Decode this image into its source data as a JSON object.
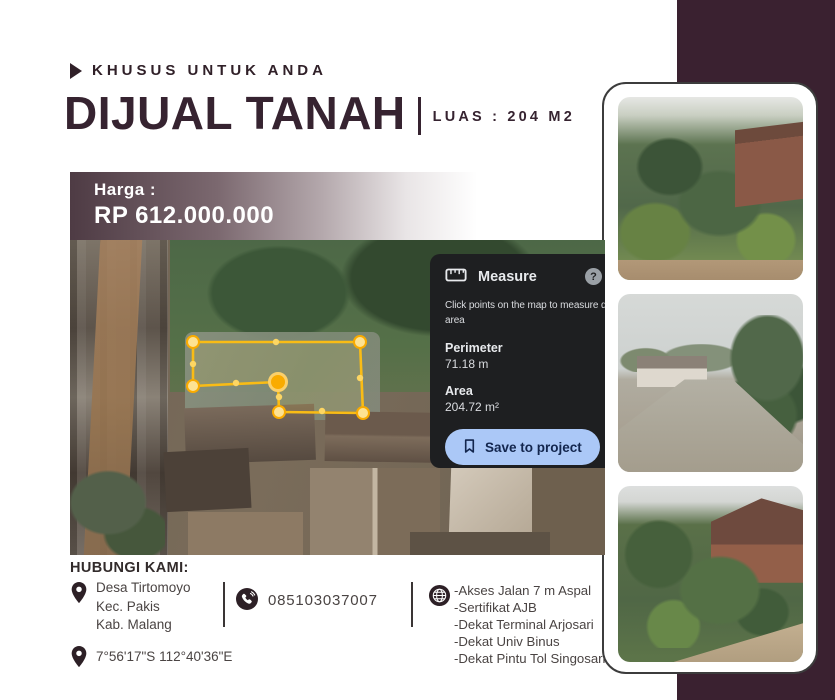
{
  "flyer": {
    "eyebrow": "KHUSUS UNTUK ANDA",
    "title": "DIJUAL TANAH",
    "area_label": "LUAS : 204 M2",
    "price_label": "Harga :",
    "price_value": "RP 612.000.000"
  },
  "measure_panel": {
    "title": "Measure",
    "help": "?",
    "desc_line1": "Click points on the map to measure d",
    "desc_line2": "area",
    "perimeter_label": "Perimeter",
    "perimeter_value": "71.18 m",
    "area_label": "Area",
    "area_value": "204.72 m²",
    "save_button": "Save to project"
  },
  "contact": {
    "heading": "HUBUNGI KAMI:",
    "address_lines": [
      "Desa Tirtomoyo",
      "Kec. Pakis",
      "Kab. Malang"
    ],
    "phone": "085103037007",
    "coordinates": "7°56'17\"S 112°40'36\"E",
    "features": [
      "-Akses Jalan 7 m Aspal",
      "-Sertifikat  AJB",
      "-Dekat Terminal Arjosari",
      "-Dekat Univ Binus",
      "-Dekat Pintu Tol Singosari"
    ]
  },
  "colors": {
    "accent_maroon": "#3a2130",
    "title_text": "#362330",
    "measure_panel_bg": "#1e1f21",
    "save_button_bg": "#abc8f7",
    "polygon_yellow": "#f9bc15"
  }
}
